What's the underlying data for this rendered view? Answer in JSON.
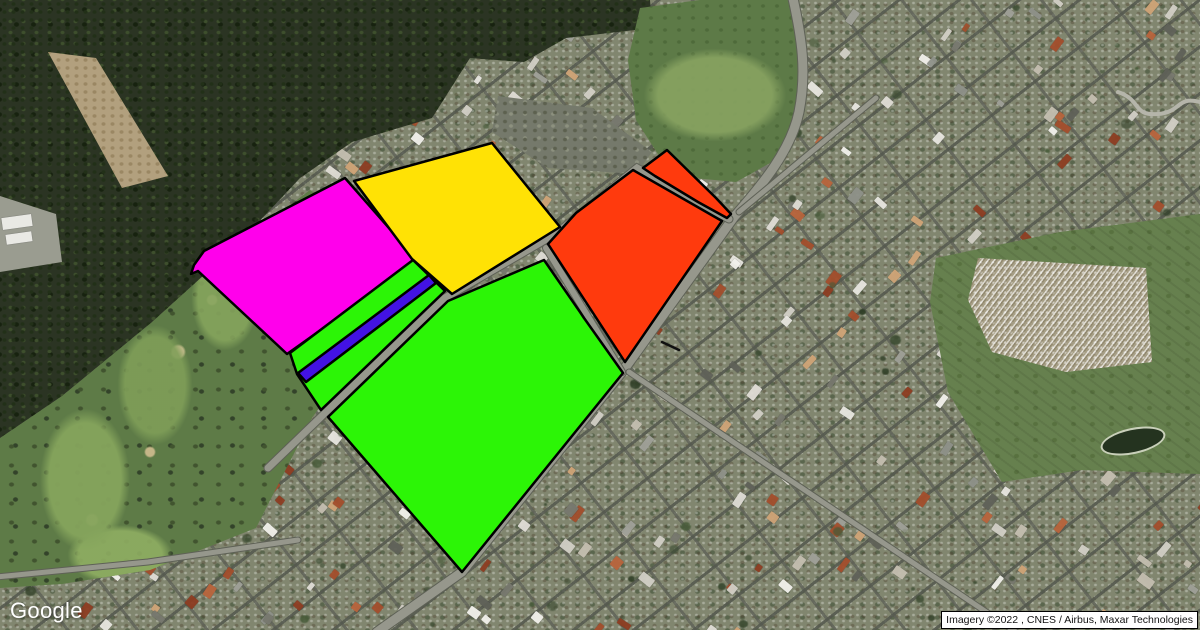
{
  "map": {
    "logo": "Google",
    "attribution": "Imagery ©2022 , CNES / Airbus, Maxar Technologies",
    "overlay_stroke": {
      "color": "#000000",
      "width": 2.5
    },
    "overlays": [
      {
        "id": "magenta-parcel",
        "fill": "#FF00EB",
        "points": [
          [
            345,
            178
          ],
          [
            418,
            261
          ],
          [
            287,
            354
          ],
          [
            198,
            271
          ],
          [
            191,
            274
          ],
          [
            194,
            265
          ],
          [
            204,
            251
          ]
        ]
      },
      {
        "id": "yellow-parcel",
        "fill": "#FFE205",
        "points": [
          [
            492,
            143
          ],
          [
            560,
            227
          ],
          [
            452,
            294
          ],
          [
            412,
            259
          ],
          [
            354,
            181
          ]
        ]
      },
      {
        "id": "green-strip-parcel",
        "fill": "#2CF506",
        "points": [
          [
            413,
            260
          ],
          [
            445,
            291
          ],
          [
            321,
            410
          ],
          [
            297,
            374
          ],
          [
            290,
            353
          ]
        ]
      },
      {
        "id": "blue-strip-parcel",
        "fill": "#4312E3",
        "points": [
          [
            429,
            275
          ],
          [
            436,
            283
          ],
          [
            306,
            382
          ],
          [
            298,
            373
          ]
        ]
      },
      {
        "id": "green-main-parcel",
        "fill": "#2CF506",
        "points": [
          [
            328,
            417
          ],
          [
            448,
            301
          ],
          [
            544,
            260
          ],
          [
            580,
            312
          ],
          [
            584,
            318
          ],
          [
            623,
            373
          ],
          [
            462,
            572
          ]
        ]
      },
      {
        "id": "red-main-parcel",
        "fill": "#FF3A0D",
        "points": [
          [
            633,
            170
          ],
          [
            722,
            221
          ],
          [
            625,
            362
          ],
          [
            548,
            244
          ],
          [
            576,
            213
          ]
        ]
      },
      {
        "id": "red-strip-parcel",
        "fill": "#FF3A0D",
        "points": [
          [
            643,
            168
          ],
          [
            667,
            150
          ],
          [
            716,
            198
          ],
          [
            731,
            214
          ],
          [
            727,
            218
          ],
          [
            698,
            202
          ],
          [
            655,
            176
          ]
        ]
      },
      {
        "id": "stray-mark",
        "fill": "none",
        "stroke": "#101010",
        "open": true,
        "points": [
          [
            662,
            342
          ],
          [
            679,
            350
          ]
        ]
      }
    ]
  }
}
